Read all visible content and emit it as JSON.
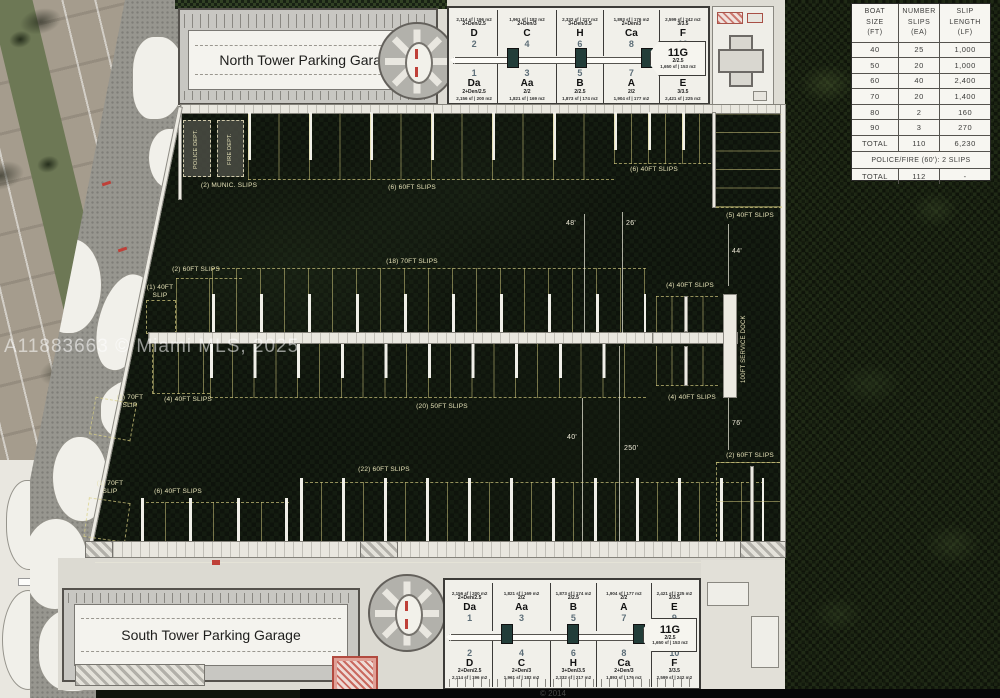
{
  "watermark": "A11883663 © Miami MLS, 2025",
  "footer": {
    "copyright": "© 2014"
  },
  "garages": {
    "north": "North Tower Parking Garage",
    "south": "South Tower Parking Garage"
  },
  "slip_table": {
    "headers": [
      "BOAT\nSIZE\n(FT)",
      "NUMBER\nSLIPS\n(EA)",
      "SLIP\nLENGTH\n(LF)"
    ],
    "rows": [
      [
        "40",
        "25",
        "1,000"
      ],
      [
        "50",
        "20",
        "1,000"
      ],
      [
        "60",
        "40",
        "2,400"
      ],
      [
        "70",
        "20",
        "1,400"
      ],
      [
        "80",
        "2",
        "160"
      ],
      [
        "90",
        "3",
        "270"
      ]
    ],
    "total": [
      "TOTAL",
      "110",
      "6,230"
    ],
    "police": "POLICE/FIRE (60'): 2 SLIPS",
    "grand": [
      "TOTAL",
      "112",
      "-"
    ]
  },
  "marina": {
    "labels": {
      "munic": "(2) MUNIC. SLIPS",
      "police": "POLICE DEPT.",
      "fire": "FIRE DEPT.",
      "top_60": "(6) 60FT SLIPS",
      "top_40": "(6) 40FT SLIPS",
      "right_40": "(5) 40FT SLIPS",
      "mid_70": "(18) 70FT SLIPS",
      "mid_60_left": "(2) 60FT SLIPS",
      "mid_40_one": "(1) 40FT\nSLIP",
      "mid_40_right_top": "(4) 40FT SLIPS",
      "mid_70_one": "(1) 70FT\nSLIP",
      "mid_40_left": "(4) 40FT SLIPS",
      "mid_50": "(20) 50FT SLIPS",
      "mid_40_right_bot": "(4) 40FT SLIPS",
      "service_dock": "100FT SERVICE DOCK",
      "bot_60": "(22) 60FT SLIPS",
      "bot_70_one": "(1) 70FT\nSLIP",
      "bot_40": "(6) 40FT SLIPS",
      "bot_60_right": "(2) 60FT SLIPS"
    },
    "dims": {
      "d48": "48'",
      "d26": "26'",
      "d44": "44'",
      "d40": "40'",
      "d250": "250'",
      "d76": "76'"
    }
  },
  "plans": {
    "north": {
      "top": [
        {
          "area": "2,114 sf | 196 m2",
          "type": "2+Den/2.5",
          "letter": "D",
          "num": "2"
        },
        {
          "area": "1,961 sf | 182 m2",
          "type": "2+Den/3",
          "letter": "C",
          "num": "4"
        },
        {
          "area": "2,332 sf | 217 m2",
          "type": "3+Den/3.5",
          "letter": "H",
          "num": "6"
        },
        {
          "area": "1,893 sf | 176 m2",
          "type": "2+Den/3",
          "letter": "Ca",
          "num": "8"
        },
        {
          "area": "2,599 sf | 242 m2",
          "type": "3/3.5",
          "letter": "F",
          "num": "10"
        }
      ],
      "bottom": [
        {
          "num": "1",
          "letter": "Da",
          "type": "2+Den/2.5",
          "area": "2,156 sf | 200 m2"
        },
        {
          "num": "3",
          "letter": "Aa",
          "type": "2/2",
          "area": "1,821 sf | 169 m2"
        },
        {
          "num": "5",
          "letter": "B",
          "type": "2/2.5",
          "area": "1,873 sf | 174 m2"
        },
        {
          "num": "7",
          "letter": "A",
          "type": "2/2",
          "area": "1,904 sf | 177 m2"
        },
        {
          "num": "9",
          "letter": "E",
          "type": "3/3.5",
          "area": "2,421 sf | 225 m2"
        }
      ],
      "g": {
        "label": "11G",
        "type": "2/2.5",
        "area": "1,650 sf | 153 m2"
      }
    },
    "south": {
      "top": [
        {
          "area": "2,156 sf | 200 m2",
          "type": "2+Den/2.5",
          "letter": "Da",
          "num": "1"
        },
        {
          "area": "1,821 sf | 169 m2",
          "type": "2/2",
          "letter": "Aa",
          "num": "3"
        },
        {
          "area": "1,873 sf | 174 m2",
          "type": "2/2.5",
          "letter": "B",
          "num": "5"
        },
        {
          "area": "1,904 sf | 177 m2",
          "type": "2/2",
          "letter": "A",
          "num": "7"
        },
        {
          "area": "2,421 sf | 225 m2",
          "type": "3/3.5",
          "letter": "E",
          "num": "9"
        }
      ],
      "bottom": [
        {
          "num": "2",
          "letter": "D",
          "type": "2+Den/2.5",
          "area": "2,114 sf | 196 m2"
        },
        {
          "num": "4",
          "letter": "C",
          "type": "2+Den/3",
          "area": "1,961 sf | 182 m2"
        },
        {
          "num": "6",
          "letter": "H",
          "type": "3+Den/3.5",
          "area": "2,332 sf | 217 m2"
        },
        {
          "num": "8",
          "letter": "Ca",
          "type": "2+Den/3",
          "area": "1,893 sf | 176 m2"
        },
        {
          "num": "10",
          "letter": "F",
          "type": "3/3.5",
          "area": "2,599 sf | 242 m2"
        }
      ],
      "g": {
        "label": "11G",
        "type": "2/2.5",
        "area": "1,650 sf | 153 m2"
      }
    }
  },
  "colors": {
    "slip_dash_yellow": "#d8ce82",
    "accent_red": "#bf4038",
    "water": "#10160e",
    "label_cream": "#e6e2b8"
  }
}
